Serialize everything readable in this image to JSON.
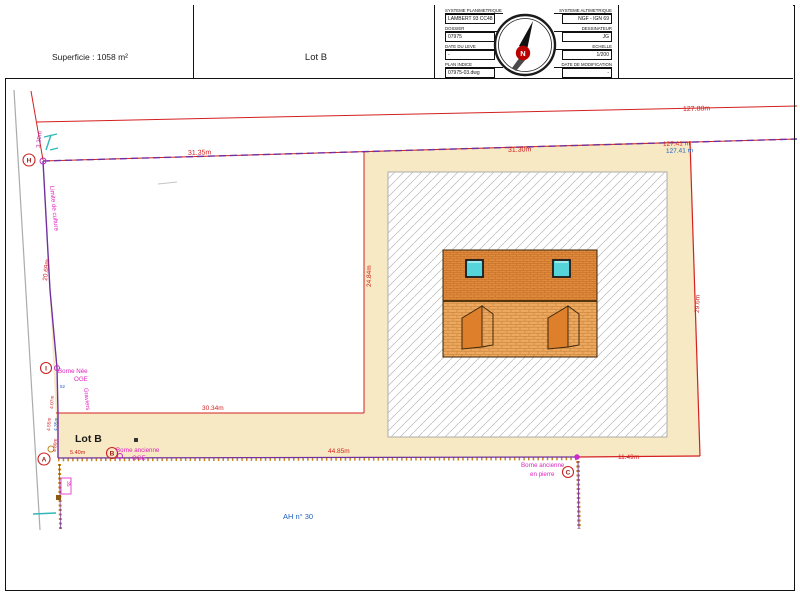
{
  "header": {
    "superficie": "Superficie : 1058 m²",
    "lot": "Lot B",
    "titleblock": {
      "sys_plan_label": "SYSTEME PLANIMETRIQUE",
      "sys_plan_value": "LAMBERT 93 CC48",
      "sys_alt_label": "SYSTEME ALTIMETRIQUE",
      "sys_alt_value": "NGF - IGN 69",
      "dossier_label": "DOSSIER",
      "dossier_value": "07975",
      "dessinateur_label": "DESSINATEUR",
      "dessinateur_value": "JG",
      "date_leve_label": "DATE DU LEVE",
      "date_leve_value": "-",
      "echelle_label": "ECHELLE",
      "echelle_value": "1/200",
      "plan_indice_label": "PLAN INDICE",
      "plan_indice_value": "07975-03.dwg",
      "date_modif_label": "DATE DE MODIFICATION",
      "date_modif_value": "-",
      "north_letter": "N"
    }
  },
  "plan": {
    "lot_label": "Lot B",
    "road_label": "AH n° 30",
    "dims": {
      "d127_88": "127.88m",
      "d127_41_red": "127.41 m",
      "d127_41_blue": "127.41 m",
      "d31_35": "31.35m",
      "d31_30": "31.30m",
      "d24_84": "24.84m",
      "d29_6": "29.6m",
      "d20_69": "20.69m",
      "d3_20": "3.20m",
      "d30_34": "30.34m",
      "d44_85": "44.85m",
      "d5_40": "5.40m",
      "d11_49": "11.49m",
      "d4_07": "4.07m",
      "d4_55": "4.55m",
      "d4_35": "4.35m",
      "d4_80": "4.80m"
    },
    "notes": {
      "limite": "Limite de culture",
      "graviers": "Graviers",
      "borne_nee_1": "Borne Née",
      "borne_nee_2": "OGE",
      "pt52": "52",
      "borne_anc_1": "Borne ancienne",
      "borne_anc_2": "OGE",
      "borne_pierre_1": "Borne ancienne",
      "borne_pierre_2": "en pierre",
      "small_box": "35"
    },
    "markers": {
      "h": "H",
      "i": "I",
      "a": "A",
      "b": "B",
      "c": "C"
    }
  },
  "colors": {
    "parcel_fill": "#F7E9C3",
    "boundary_purple": "#7030A0",
    "dimension_red": "#D42020",
    "note_magenta": "#E020C0",
    "label_blue": "#1B5FBF",
    "teal_symbol": "#2FB8B8",
    "roof_orange": "#E08A3E",
    "wall_orange": "#ECA95F",
    "boundary_gold": "#C8861A"
  }
}
